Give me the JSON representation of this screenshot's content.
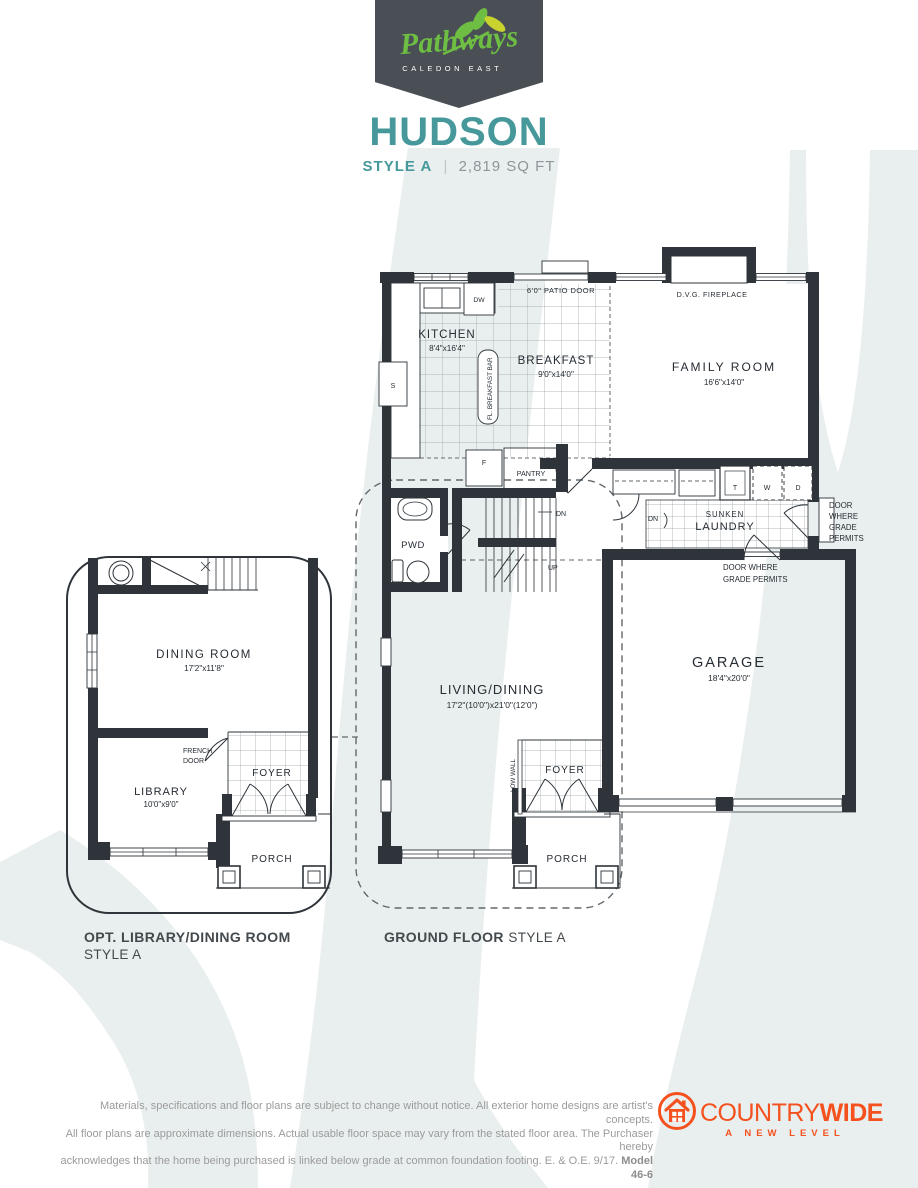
{
  "header": {
    "brand_script": "Pathways",
    "brand_sub": "CALEDON EAST",
    "model_name": "HUDSON",
    "style_label": "STYLE A",
    "separator": "|",
    "sqft": "2,819 SQ FT"
  },
  "ground_floor": {
    "caption_bold": "GROUND FLOOR",
    "caption_style": "STYLE A",
    "kitchen_name": "KITCHEN",
    "kitchen_dim": "8'4\"x16'4\"",
    "breakfast_name": "BREAKFAST",
    "breakfast_dim": "9'0\"x14'0\"",
    "family_name": "FAMILY ROOM",
    "family_dim": "16'6\"x14'0\"",
    "living_name": "LIVING/DINING",
    "living_dim": "17'2\"(10'0\")x21'0\"(12'0\")",
    "garage_name": "GARAGE",
    "garage_dim": "18'4\"x20'0\"",
    "laundry_line1": "SUNKEN",
    "laundry_line2": "LAUNDRY",
    "pwd": "PWD",
    "foyer": "FOYER",
    "porch": "PORCH",
    "pantry": "PANTRY",
    "patio_door": "6'0\" PATIO DOOR",
    "fireplace": "D.V.G. FIREPLACE",
    "breakfast_bar": "FL. BREAKFAST BAR",
    "low_wall": "LOW WALL",
    "dn": "DN",
    "up": "UP",
    "dw": "DW",
    "s": "S",
    "f": "F",
    "t": "T",
    "w": "W",
    "d": "D",
    "door_grade_1": "DOOR",
    "door_grade_2": "WHERE",
    "door_grade_3": "GRADE",
    "door_grade_4": "PERMITS",
    "garage_door_grade_1": "DOOR WHERE",
    "garage_door_grade_2": "GRADE PERMITS"
  },
  "option_plan": {
    "caption_bold": "OPT. LIBRARY/DINING ROOM",
    "caption_style": "STYLE A",
    "dining_name": "DINING ROOM",
    "dining_dim": "17'2\"x11'8\"",
    "library_name": "LIBRARY",
    "library_dim": "10'0\"x9'0\"",
    "french_1": "FRENCH",
    "french_2": "DOOR",
    "foyer": "FOYER",
    "porch": "PORCH"
  },
  "footer": {
    "disclaimer_1": "Materials, specifications and floor plans are subject to change without notice. All exterior home designs are artist's concepts.",
    "disclaimer_2": "All floor plans are approximate dimensions. Actual usable floor space may vary from the stated floor area. The Purchaser hereby",
    "disclaimer_3": "acknowledges that the home being purchased is linked below grade at common foundation footing. E. & O.E. 9/17. ",
    "model_ref": "Model 46-6",
    "brand_part1": "COUNTRY",
    "brand_part2": "WIDE",
    "brand_tagline": "A NEW LEVEL"
  },
  "colors": {
    "teal_accent": "#47989B",
    "badge_slate": "#494F55",
    "logo_green": "#6FBE44",
    "leaf_yellow": "#C9D22F",
    "countrywide_orange": "#F4511E",
    "wall_ink": "#2E343A",
    "swoosh_tint": "#E9EFEE",
    "disclaimer_gray": "#9B9B9B"
  }
}
